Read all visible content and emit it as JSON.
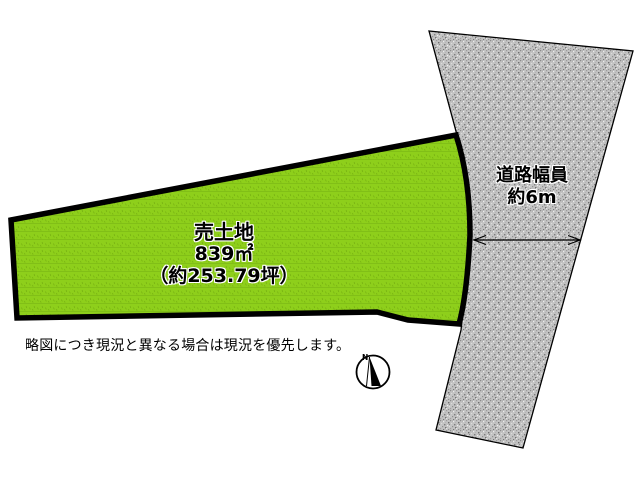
{
  "plot": {
    "title": "売土地",
    "area_sqm": "839㎡",
    "area_tsubo": "（約253.79坪）",
    "fill_color": "#8ecf1b",
    "stripe_color": "#7cb915",
    "outline_color": "#000000"
  },
  "road": {
    "width_label": "道路幅員",
    "width_value": "約6m",
    "fill_color": "#c2c2c2",
    "outline_color": "#000000"
  },
  "compass": {
    "north_label": "N"
  },
  "disclaimer": "略図につき現況と異なる場合は現況を優先します。"
}
